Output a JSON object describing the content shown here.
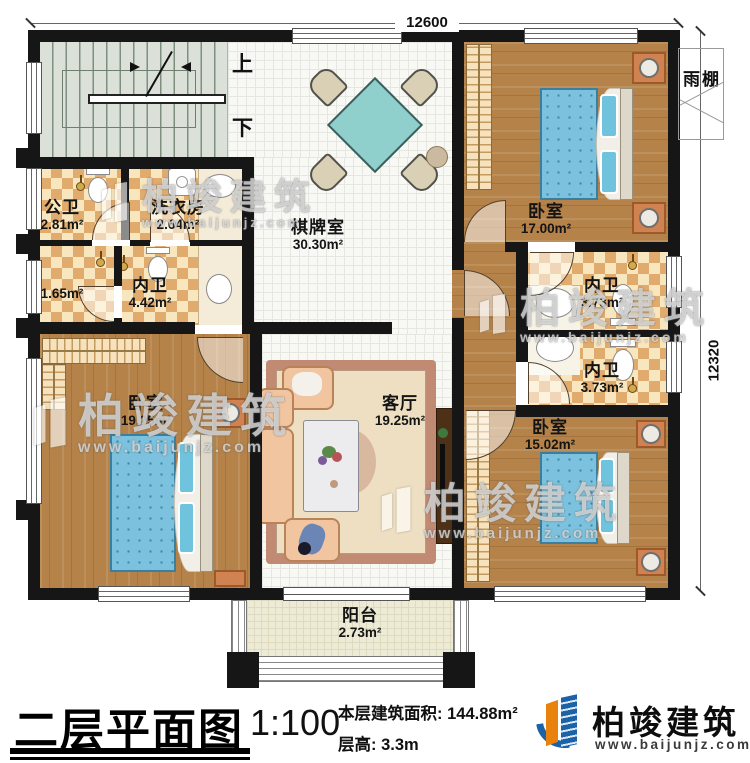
{
  "dims": {
    "top": "12600",
    "right": "12320"
  },
  "annotations": {
    "canopy": "雨棚",
    "up": "上",
    "down": "下"
  },
  "rooms": {
    "gongwei": {
      "name": "公卫",
      "area": "2.81m²"
    },
    "xiyifang": {
      "name": "洗衣房",
      "area": "2.64m²"
    },
    "closet": {
      "area": "1.65m²"
    },
    "neiwei_main": {
      "name": "内卫",
      "area": "4.42m²"
    },
    "qipaishi": {
      "name": "棋牌室",
      "area": "30.30m²"
    },
    "bedroom_ne": {
      "name": "卧室",
      "area": "17.00m²"
    },
    "neiwei_e1": {
      "name": "内卫",
      "area": "3.73m²"
    },
    "neiwei_e2": {
      "name": "内卫",
      "area": "3.73m²"
    },
    "bedroom_sw": {
      "name": "卧室",
      "area": "19.25m²"
    },
    "keting": {
      "name": "客厅",
      "area": "19.25m²"
    },
    "bedroom_se": {
      "name": "卧室",
      "area": "15.02m²"
    },
    "yangtai": {
      "name": "阳台",
      "area": "2.73m²"
    }
  },
  "titleblock": {
    "title": "二层平面图",
    "scale": "1:100",
    "area_label": "本层建筑面积: ",
    "area_value": "144.88m²",
    "height_label": "层高: ",
    "height_value": "3.3m"
  },
  "brand": {
    "name": "柏竣建筑",
    "site": "www.baijunjz.com"
  },
  "watermark": {
    "text": "柏竣建筑",
    "site": "www.baijunjz.com"
  },
  "colors": {
    "wall": "#161616",
    "wood_floor": "#b5834a",
    "checker_tan": "#e1ab6e",
    "bed_blue": "#7cc2de",
    "table_teal": "#8fd0cc",
    "brand_blue": "#1b63a8",
    "brand_orange": "#e8820c"
  }
}
